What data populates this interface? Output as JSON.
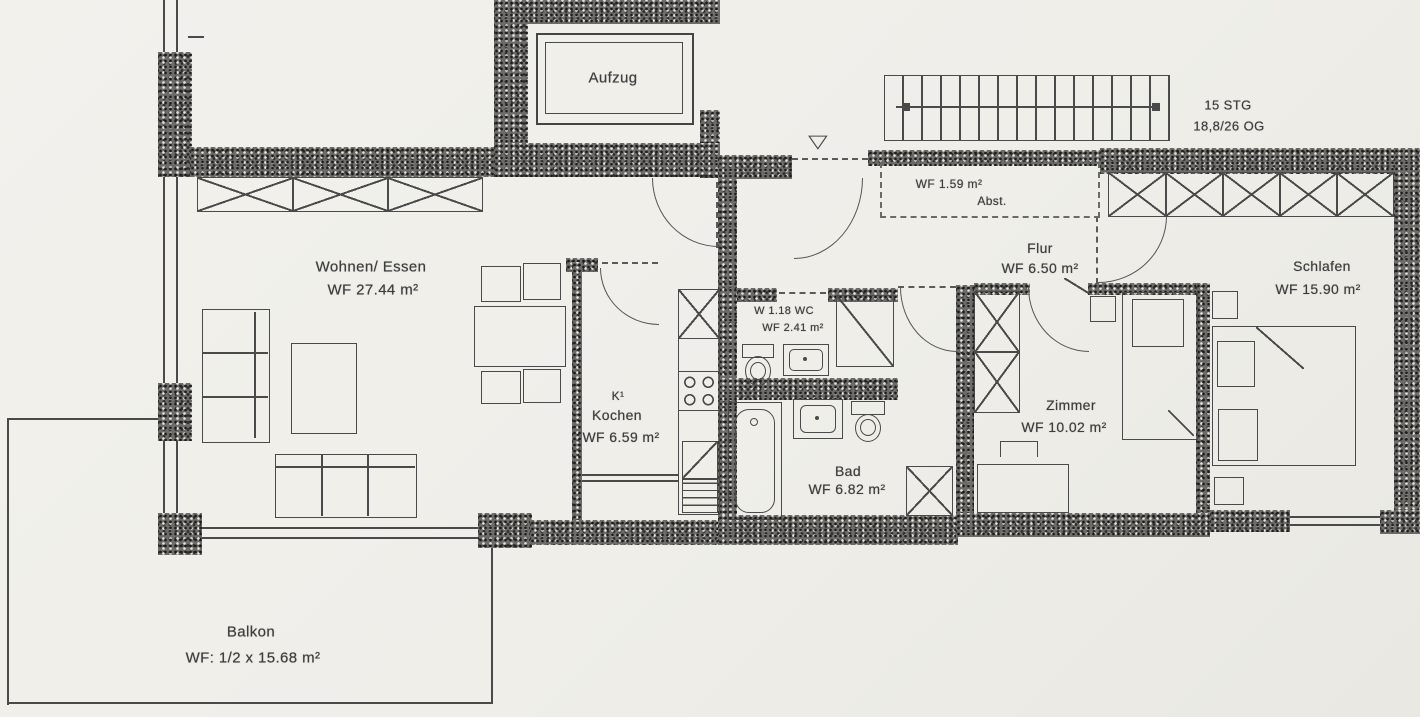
{
  "colors": {
    "paper": "#efeee9",
    "ink": "#4a4a4a"
  },
  "icons": {
    "entrance_marker": "▽"
  },
  "rooms": {
    "aufzug": {
      "name": "Aufzug"
    },
    "wohnen_essen": {
      "name": "Wohnen/ Essen",
      "area": "WF 27.44 m²"
    },
    "kochen": {
      "tag": "K¹",
      "name": "Kochen",
      "area": "WF 6.59 m²"
    },
    "wc": {
      "name": "W 1.18   WC",
      "area": "WF 2.41 m²"
    },
    "bad": {
      "name": "Bad",
      "area": "WF 6.82 m²"
    },
    "flur": {
      "name": "Flur",
      "area": "WF 6.50 m²"
    },
    "abstellraum": {
      "area": "WF 1.59 m²",
      "name": "Abst."
    },
    "zimmer": {
      "name": "Zimmer",
      "area": "WF 10.02 m²"
    },
    "schlafen": {
      "name": "Schlafen",
      "area": "WF 15.90 m²"
    },
    "balkon": {
      "name": "Balkon",
      "area": "WF: 1/2 x 15.68 m²"
    }
  },
  "stairs": {
    "line1": "15 STG",
    "line2": "18,8/26 OG"
  }
}
